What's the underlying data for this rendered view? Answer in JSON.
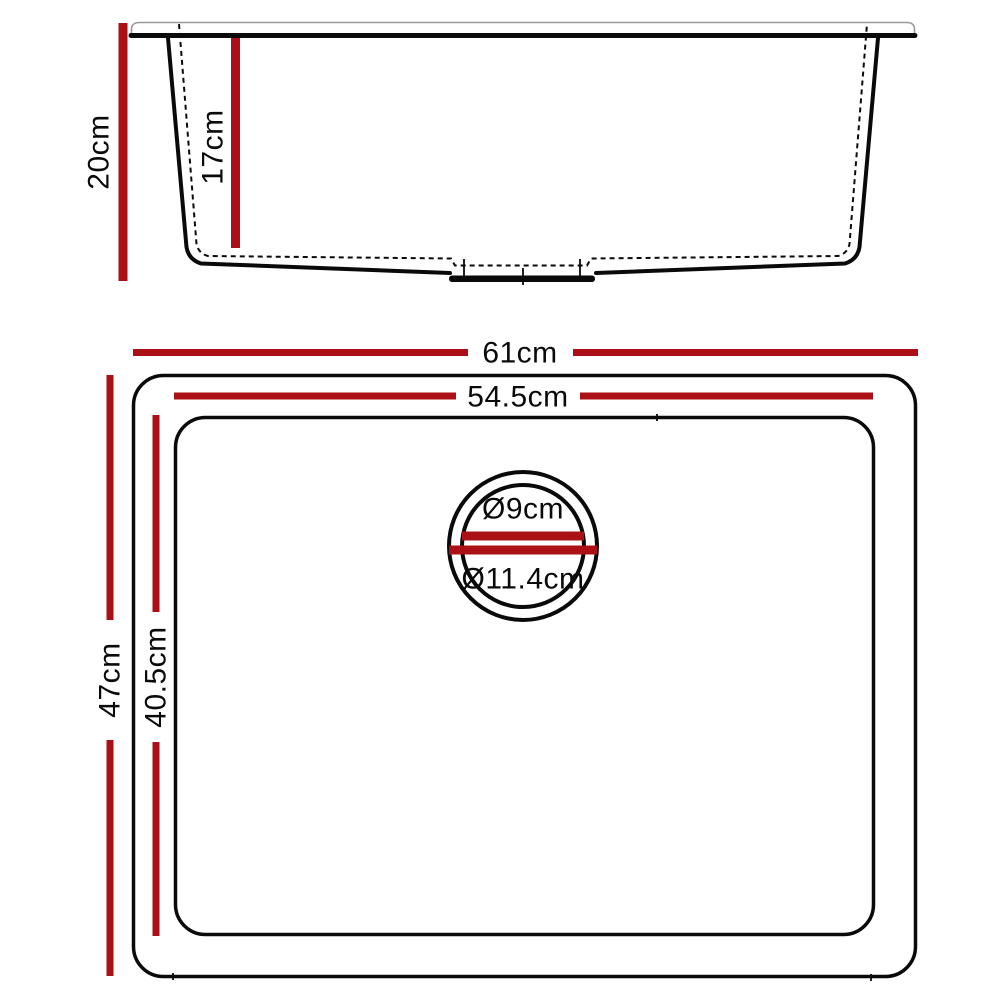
{
  "colors": {
    "dimension_red": "#AA1016",
    "outline_black": "#0a0a0a"
  },
  "side_view": {
    "overall_height_label": "20cm",
    "bowl_depth_label": "17cm"
  },
  "top_view": {
    "overall_width_label": "61cm",
    "bowl_width_label": "54.5cm",
    "overall_depth_label": "47cm",
    "bowl_depth_label": "40.5cm",
    "drain": {
      "inner_diameter_label": "Ø9cm",
      "outer_diameter_label": "Ø11.4cm"
    }
  }
}
